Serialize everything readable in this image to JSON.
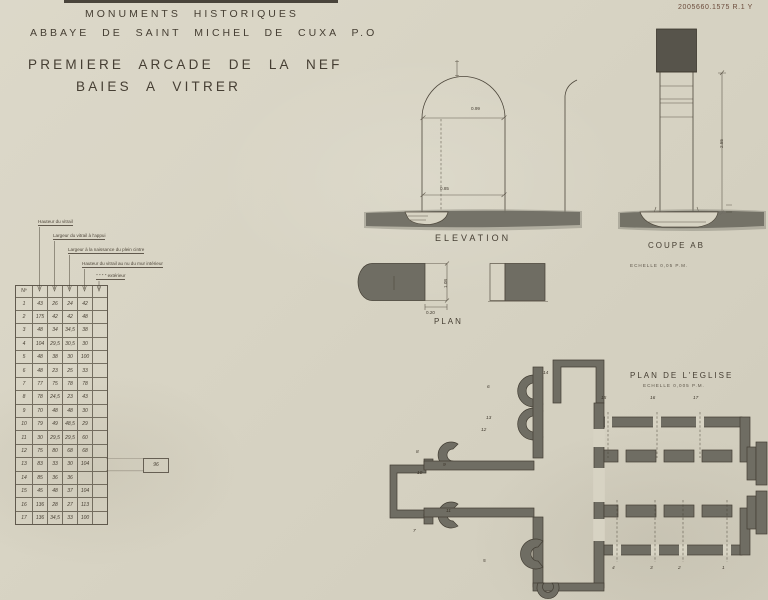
{
  "stamp": "2005660.1575 R.1 Y",
  "header": {
    "line1": "MONUMENTS HISTORIQUES",
    "line2": "ABBAYE DE SAINT MICHEL DE CUXA P.O",
    "title1": "PREMIERE ARCADE DE LA NEF",
    "title2": "BAIES A VITRER"
  },
  "table": {
    "corner": "Nº",
    "annotations": [
      "Hauteur du vitrail",
      "Largeur du vitrail à l'appui",
      "Largeur à la naissance du plein cintre",
      "Hauteur du vitrail au nu du mur intérieur",
      "″     ″     ″     ″   extérieur"
    ],
    "rows": [
      {
        "n": "1",
        "v": [
          "43",
          "26",
          "24",
          "42",
          ""
        ]
      },
      {
        "n": "2",
        "v": [
          "175",
          "42",
          "42",
          "48",
          ""
        ]
      },
      {
        "n": "3",
        "v": [
          "48",
          "34",
          "34,5",
          "38",
          ""
        ]
      },
      {
        "n": "4",
        "v": [
          "104",
          "29,5",
          "30,5",
          "30",
          ""
        ]
      },
      {
        "n": "5",
        "v": [
          "48",
          "38",
          "30",
          "100",
          ""
        ]
      },
      {
        "n": "6",
        "v": [
          "48",
          "23",
          "25",
          "33",
          ""
        ]
      },
      {
        "n": "7",
        "v": [
          "77",
          "75",
          "78",
          "78",
          ""
        ]
      },
      {
        "n": "8",
        "v": [
          "78",
          "24,5",
          "23",
          "43",
          ""
        ]
      },
      {
        "n": "9",
        "v": [
          "70",
          "48",
          "48",
          "30",
          ""
        ]
      },
      {
        "n": "10",
        "v": [
          "79",
          "49",
          "48,5",
          "29",
          ""
        ]
      },
      {
        "n": "11",
        "v": [
          "30",
          "29,5",
          "29,5",
          "60",
          ""
        ]
      },
      {
        "n": "12",
        "v": [
          "75",
          "80",
          "68",
          "68",
          ""
        ]
      },
      {
        "n": "13",
        "v": [
          "83",
          "33",
          "30",
          "104",
          ""
        ]
      },
      {
        "n": "14",
        "v": [
          "85",
          "36",
          "36",
          "",
          ""
        ]
      },
      {
        "n": "15",
        "v": [
          "45",
          "48",
          "37",
          "104",
          ""
        ]
      },
      {
        "n": "16",
        "v": [
          "136",
          "28",
          "27",
          "113",
          ""
        ]
      },
      {
        "n": "17",
        "v": [
          "136",
          "34,5",
          "33",
          "100",
          ""
        ]
      }
    ],
    "row14_extra": "96"
  },
  "elevation": {
    "label": "ELEVATION",
    "dim_top": "0.99",
    "dim_bottom": "0.85"
  },
  "coupe": {
    "label": "COUPE AB",
    "scale": "ECHELLE 0,05 P.M.",
    "dim_height": "2.55"
  },
  "plan": {
    "label": "PLAN",
    "dim_depth": "1.08",
    "dim_reveal": "0.20"
  },
  "eglise": {
    "title": "PLAN DE L'EGLISE",
    "scale": "ECHELLE 0,005 P.M.",
    "bays_top": [
      "15",
      "16",
      "17"
    ],
    "bays_bottom": [
      "4",
      "3",
      "2",
      "1"
    ],
    "bays_around": [
      "6",
      "13",
      "12",
      "14",
      "8",
      "9",
      "10",
      "11",
      "7",
      "5"
    ]
  }
}
